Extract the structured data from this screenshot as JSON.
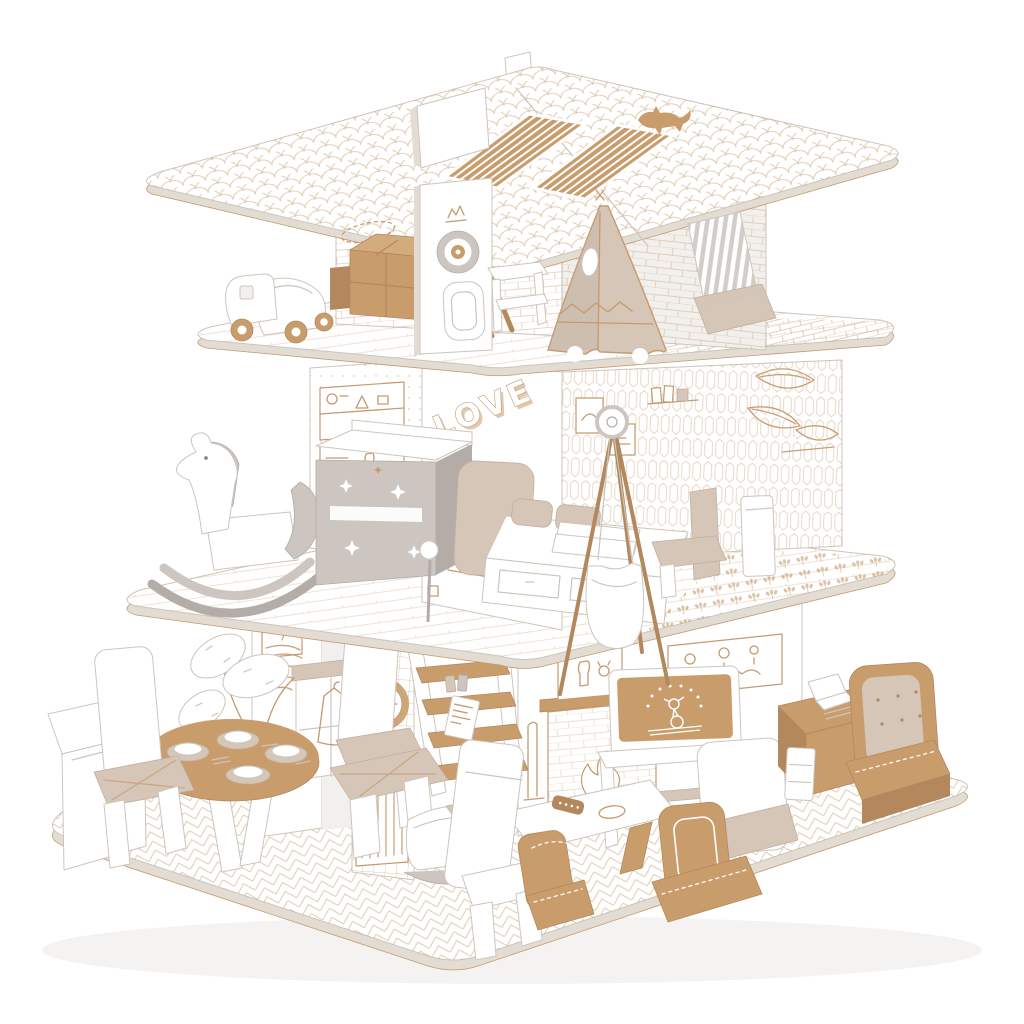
{
  "scene": {
    "subject": "Cardboard dollhouse playset",
    "style": "three-storey white corrugated cardboard toy house decorated with tan line-art prints",
    "love_text": "LOVE",
    "floors": [
      {
        "label": "attic playroom",
        "objects": [
          "shingle-print roof",
          "solar panel cutouts",
          "cat silhouette",
          "chimney tab",
          "toy truck",
          "cardboard boxes",
          "leaning easel ladder",
          "dartboard partition",
          "toy console",
          "teepee tent",
          "striped deck chair",
          "brick-print walls",
          "brick-print balcony"
        ]
      },
      {
        "label": "bedroom",
        "objects": [
          "rocking horse",
          "star dresser",
          "LOVE wall",
          "framed botanical print",
          "bed with drawers",
          "pillows",
          "hanging cradle stand",
          "picket-print wallpaper",
          "wall shelf doodles",
          "clover-print balcony",
          "white planter"
        ]
      },
      {
        "label": "living room",
        "objects": [
          "round dining table with plates",
          "cut-out chairs",
          "prickly-pear plant",
          "kitchen counter",
          "tiled clock wall",
          "radiator print",
          "ladder shelf",
          "rocking cradle",
          "fireplace print",
          "tv on console",
          "coffee table",
          "remote control",
          "cardboard armchairs",
          "white sofa",
          "desk with laptop",
          "tufted lounge chair",
          "herringbone floor"
        ]
      }
    ]
  },
  "colors": {
    "background": "#ffffff",
    "kraft": "#c99c6c",
    "kraftDark": "#b2885c",
    "beige": "#d5c6b8",
    "beigeDark": "#c2b0a0",
    "greige": "#ccc5c0",
    "greigeDark": "#b4aca6",
    "line": "#c49a6e",
    "edgeLine": "#ccc5bd",
    "panel": "#f2f0ed",
    "panelDark": "#e3dcd3",
    "shadow": "#eceae6"
  }
}
